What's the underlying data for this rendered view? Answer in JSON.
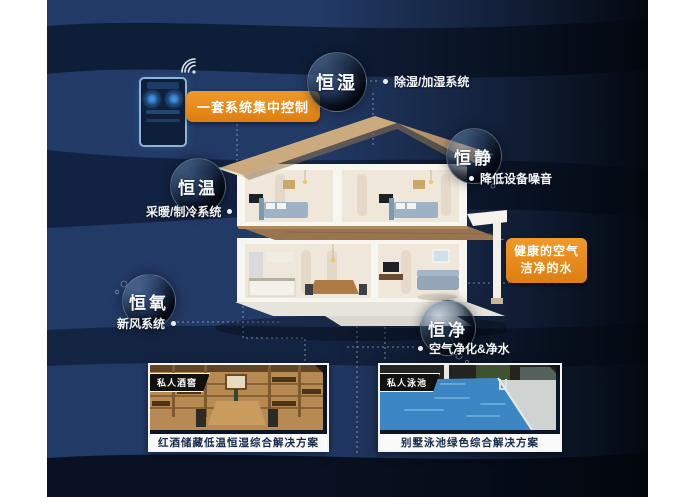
{
  "scene": {
    "control_app": {
      "pill_label": "一套系统集中控制",
      "wifi_icon": "wifi-signal-icon",
      "phone_icon": "smart-thermostat-app"
    },
    "bubbles": {
      "humidity": {
        "label": "恒湿",
        "note": "除湿/加湿系统"
      },
      "quiet": {
        "label": "恒静",
        "note": "降低设备噪音"
      },
      "temperature": {
        "label": "恒温",
        "note": "采暖/制冷系统"
      },
      "oxygen": {
        "label": "恒氧",
        "note": "新风系统"
      },
      "purity": {
        "label": "恒净",
        "note": "空气净化&净水"
      }
    },
    "highlight": {
      "line1": "健康的空气",
      "line2": "洁净的水"
    },
    "cards": {
      "wine": {
        "tag": "私人酒窖",
        "caption": "红酒储藏低温恒湿综合解决方案"
      },
      "pool": {
        "tag": "私人泳池",
        "caption": "别墅泳池绿色综合解决方案"
      }
    },
    "colors": {
      "accent_orange": "#e8891d",
      "background_navy": "#203763",
      "band_dark_navy": "#0a1629",
      "caption_text": "#15294a",
      "text_white": "#f2f5f9"
    }
  }
}
